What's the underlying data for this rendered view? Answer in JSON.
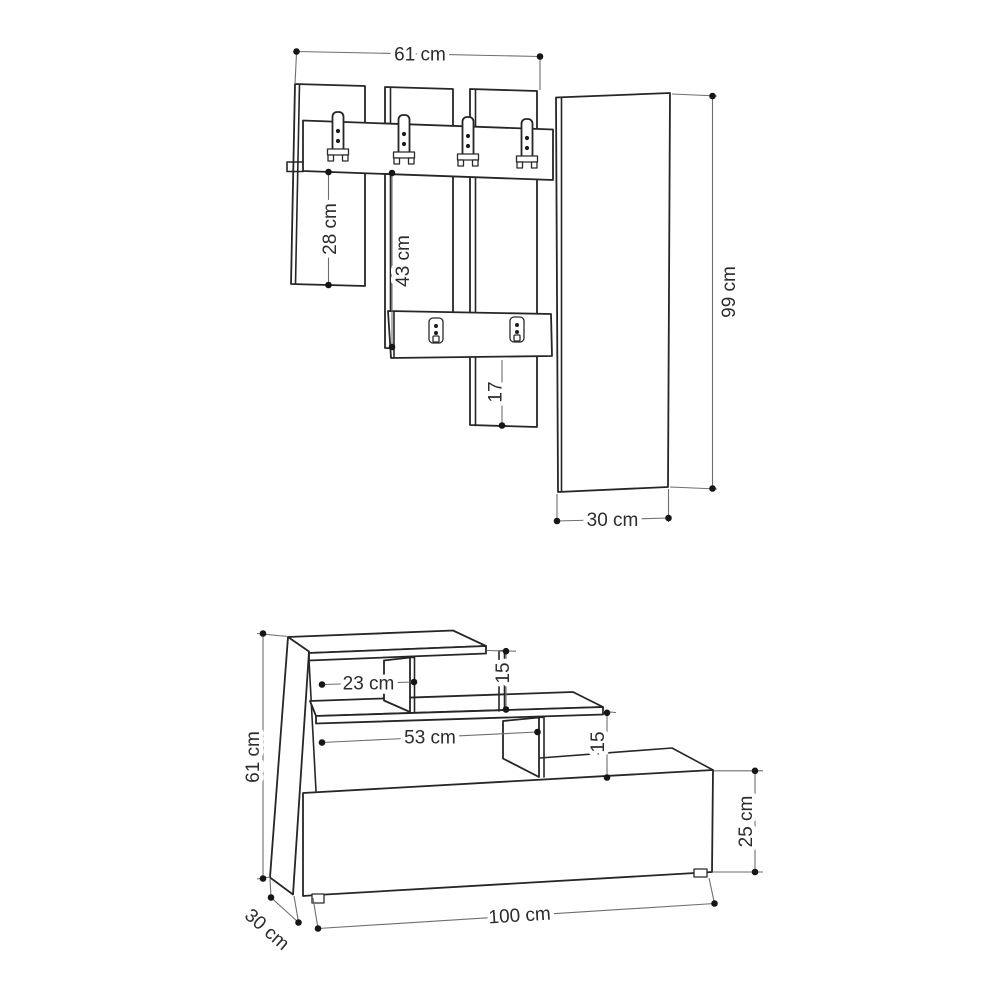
{
  "wall_unit": {
    "top_width": "61 cm",
    "left_panel_height_below_rail": "28 cm",
    "center_panel_height_below_rail": "43 cm",
    "lower_panel_extension": "17",
    "tall_panel_height": "99 cm",
    "tall_panel_width": "30 cm"
  },
  "bench": {
    "total_height": "61 cm",
    "top_compartment_width": "23 cm",
    "top_step_height": "15",
    "middle_shelf_width": "53 cm",
    "middle_step_height": "15",
    "base_cabinet_height": "25 cm",
    "total_width": "100 cm",
    "depth": "30 cm"
  }
}
